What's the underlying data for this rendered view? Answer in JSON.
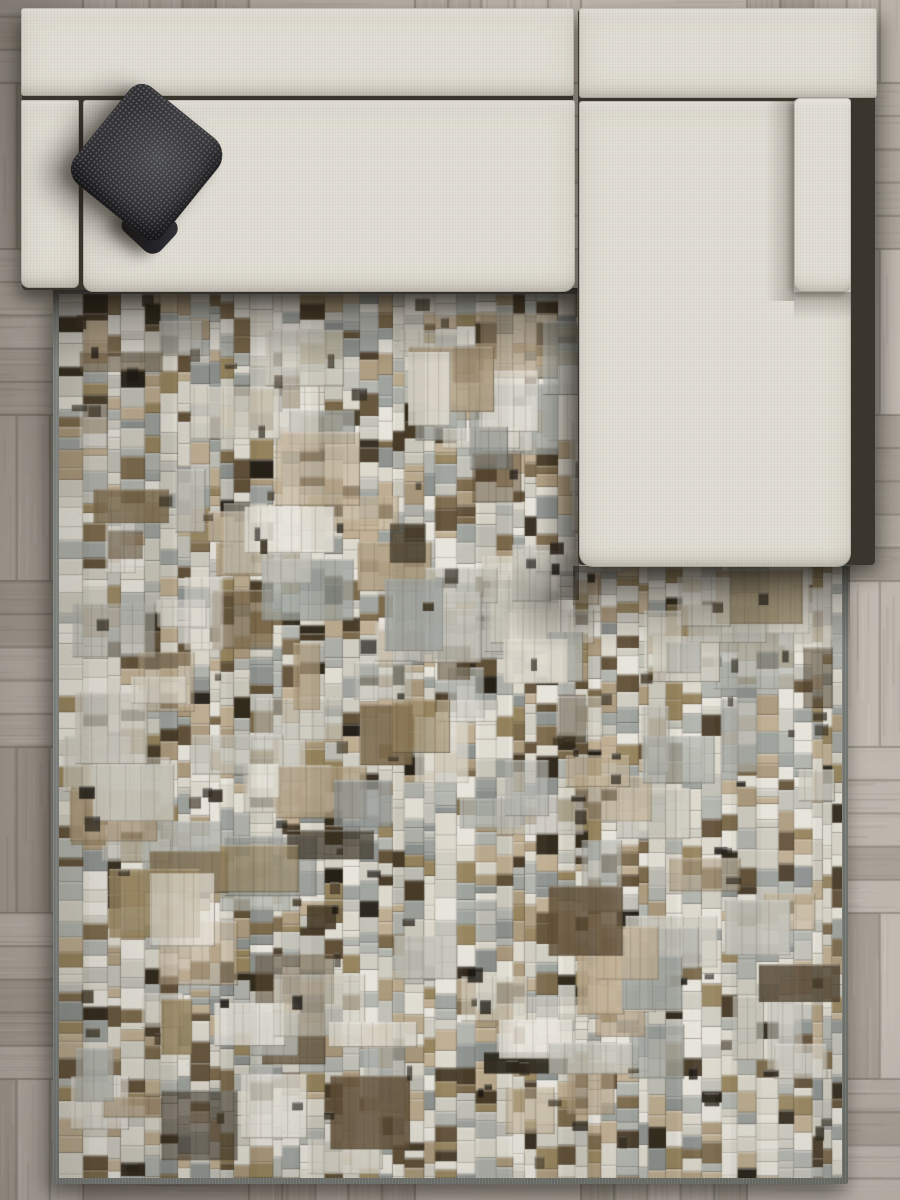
{
  "scene": {
    "title": "",
    "description": "Top-down interior staging: beige L-shaped sectional sofa with dark gray knitted throw pillow on a distressed mosaic patchwork rug over taupe parquet wood floor",
    "objects": [
      {
        "id": "wood-floor",
        "label": "parquet wood floor",
        "color": "#b1a99f"
      },
      {
        "id": "area-rug",
        "label": "mosaic patchwork area rug",
        "color": "#c8c4b9"
      },
      {
        "id": "sectional-sofa",
        "label": "L-shaped sectional sofa",
        "color": "#e1ded5"
      },
      {
        "id": "throw-pillow",
        "label": "dark knitted throw pillow",
        "color": "#2c2b2e"
      }
    ]
  },
  "palette": {
    "floor": {
      "base": "#b1a99f",
      "plankDark": "#a29a90",
      "plankLight": "#c2bbb2",
      "gapLine": "rgba(82,75,66,0.38)",
      "grainDark": "74,66,56",
      "grainLight": "255,255,255"
    },
    "sofa": {
      "fabric": "#e1ded5",
      "seamShadow": "#3a352d"
    },
    "pillow": {
      "base": "#2c2b2e",
      "highlight": "#4b4c4f",
      "dot": "#a0a39e",
      "flap": "#1d1c20"
    },
    "rug": {
      "binding": "#7b7f7c",
      "base": "#c8c4b9",
      "colors": [
        "#e7e4db",
        "#dcd8cc",
        "#cfccc1",
        "#c2c1b8",
        "#b2b4ae",
        "#9fa39e",
        "#8f9390",
        "#bfae92",
        "#ad9b7e",
        "#97855f",
        "#7c6a4c",
        "#63523a",
        "#4a3d2a",
        "#332b1d",
        "#262118"
      ],
      "weights": [
        9,
        10,
        8,
        6,
        6,
        4,
        3,
        5,
        4,
        3,
        3,
        2,
        2,
        1.5,
        1
      ],
      "accents": [
        "#2a241a",
        "#3c3222",
        "#171410"
      ]
    }
  },
  "texture": {
    "seedFloor": 20240601,
    "seedRug": 987654321,
    "floor": {
      "block": 166,
      "planksPerBlock": 5,
      "grainStreaks": 11
    },
    "rug": {
      "cellWMin": 9,
      "cellWMax": 25,
      "cellHMin": 7,
      "cellHMax": 23,
      "patches": 175,
      "patchWMin": 26,
      "patchWMax": 92,
      "patchHMin": 20,
      "patchHMax": 74,
      "darkAccents": 115,
      "speckles": 5200,
      "stripePeriod": 84
    }
  }
}
